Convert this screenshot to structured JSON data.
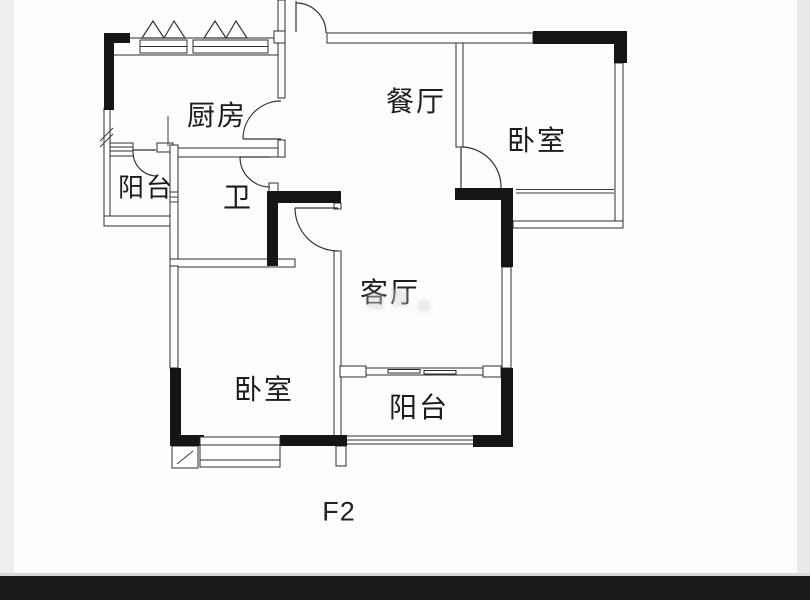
{
  "floor_plan": {
    "rooms": [
      {
        "id": "kitchen",
        "label": "厨房"
      },
      {
        "id": "dining",
        "label": "餐厅"
      },
      {
        "id": "bedroom-right",
        "label": "卧室"
      },
      {
        "id": "balcony-left",
        "label": "阳台"
      },
      {
        "id": "bathroom",
        "label": "卫"
      },
      {
        "id": "living",
        "label": "客厅"
      },
      {
        "id": "bedroom-left",
        "label": "卧室"
      },
      {
        "id": "balcony-bottom",
        "label": "阳台"
      }
    ],
    "floor_label": "F2",
    "colors": {
      "wall_solid": "#151515",
      "wall_line": "#2e2e2e",
      "background": "#fdfdfd",
      "bottom_bar": "#1b1b1b",
      "edge_band": "#ebebeb"
    }
  }
}
